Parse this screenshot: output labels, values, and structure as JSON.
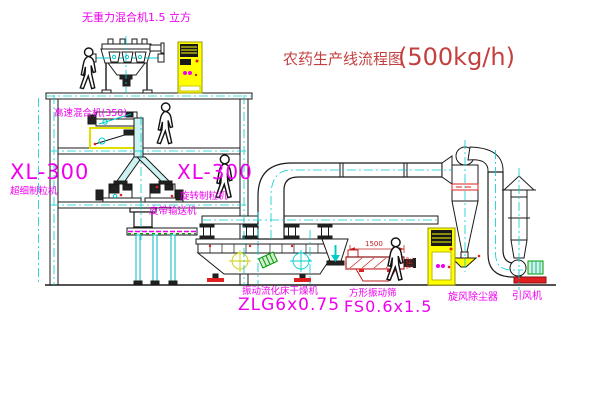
{
  "title": {
    "text": "农药生产线流程图",
    "capacity": "(500kg/h)"
  },
  "labels": {
    "zero_gravity_mixer": "无重力混合机1.5 立方",
    "high_speed_mixer": "高速混合机(350)",
    "pulverizer": {
      "model": "XL-300",
      "name": "超细制粒机"
    },
    "granulator": {
      "model": "XL-300",
      "name": "旋转制粒机"
    },
    "belt_conveyor": "皮带输送机",
    "dryer": {
      "name": "振动流化床干燥机",
      "model": "ZLG6x0.75"
    },
    "sieve": {
      "name": "方形振动筛",
      "model": "FS0.6x1.5"
    },
    "cyclone": "旋风除尘器",
    "fan": "引风机"
  },
  "dimensions": {
    "sieve_length": "1500",
    "sieve_height": "345"
  },
  "colors": {
    "label_magenta": "#ee00ee",
    "title_red": "#c44040",
    "line_black": "#1a1a1a",
    "centerline_cyan": "#00cccc",
    "cabinet_yellow": "#ffff00",
    "accent_red": "#e02020",
    "accent_green": "#009900"
  }
}
